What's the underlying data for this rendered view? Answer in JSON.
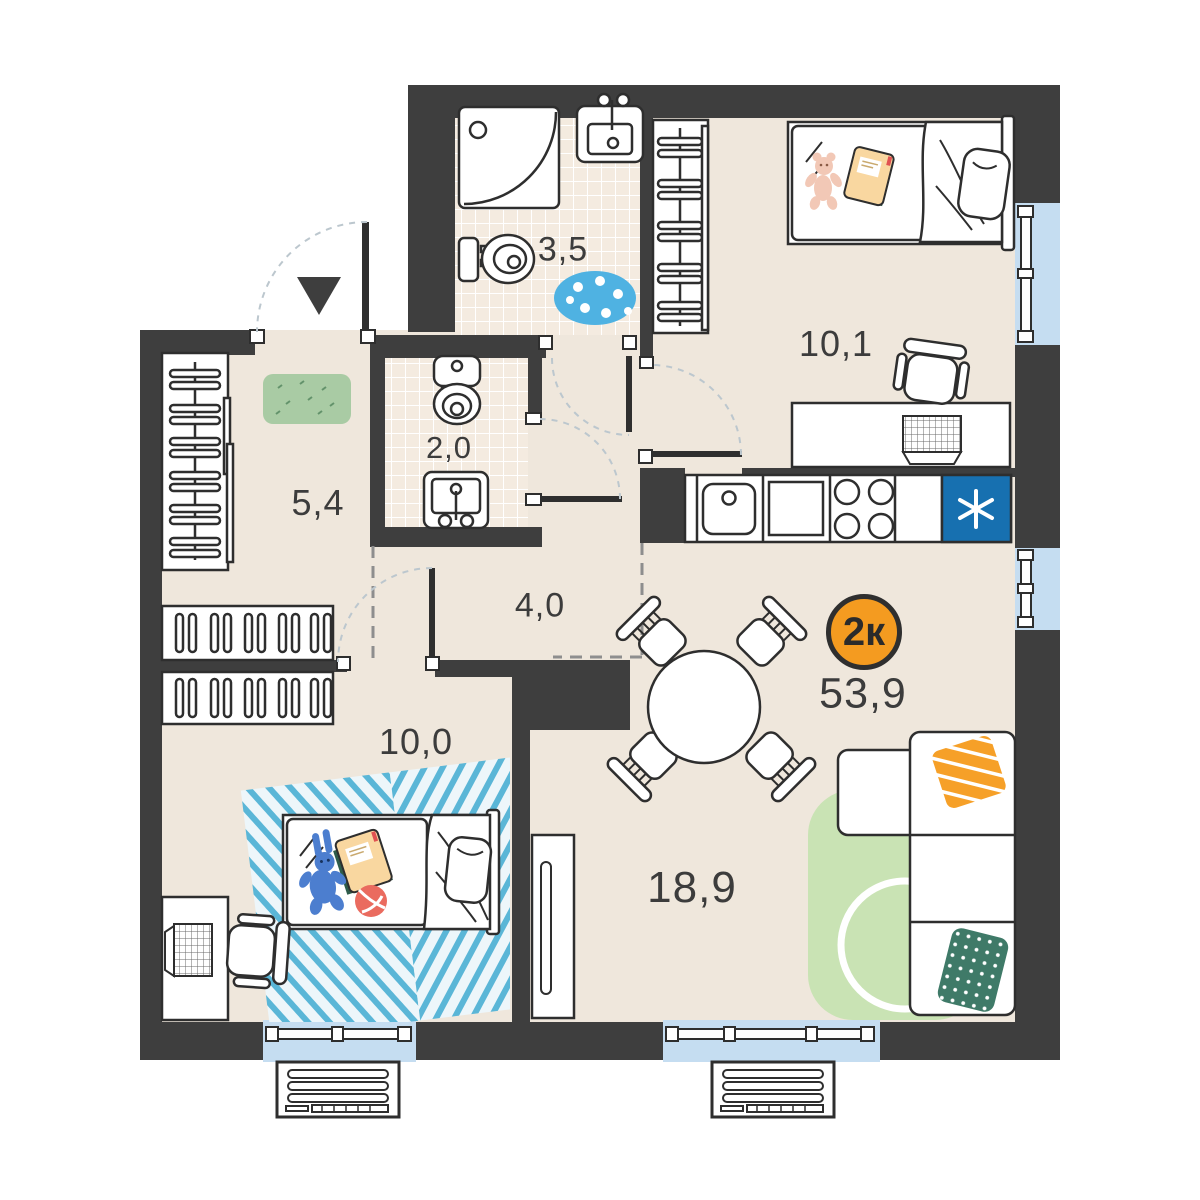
{
  "plan": {
    "title": "2-room apartment floor plan",
    "type_badge": {
      "label": "2к",
      "total_area": "53,9"
    },
    "rooms": [
      {
        "name": "bathroom",
        "area": "3,5"
      },
      {
        "name": "wc",
        "area": "2,0"
      },
      {
        "name": "hallway",
        "area": "5,4"
      },
      {
        "name": "corridor",
        "area": "4,0"
      },
      {
        "name": "bedroom-bottom",
        "area": "10,0"
      },
      {
        "name": "bedroom-top",
        "area": "10,1"
      },
      {
        "name": "living-kitchen",
        "area": "18,9"
      }
    ],
    "colors": {
      "wall": "#3E3E3E",
      "floor": "#EFE7DC",
      "tile_floor": "#F4EBE0",
      "window_glass": "#C5DDF1",
      "fridge_blue": "#1770B0",
      "badge_orange": "#F49B20",
      "hall_rug_green": "#A9CBA4",
      "living_rug_green": "#C9E3B4",
      "bath_rug_blue": "#4FB2E2",
      "bedroom_rug_stripe": "#5AB6D7",
      "pillow_orange": "#F6A028",
      "pillow_green": "#3F7A68"
    },
    "icons": {
      "fridge": "snowflake-asterisk",
      "entrance": "triangle-down-arrow"
    }
  }
}
